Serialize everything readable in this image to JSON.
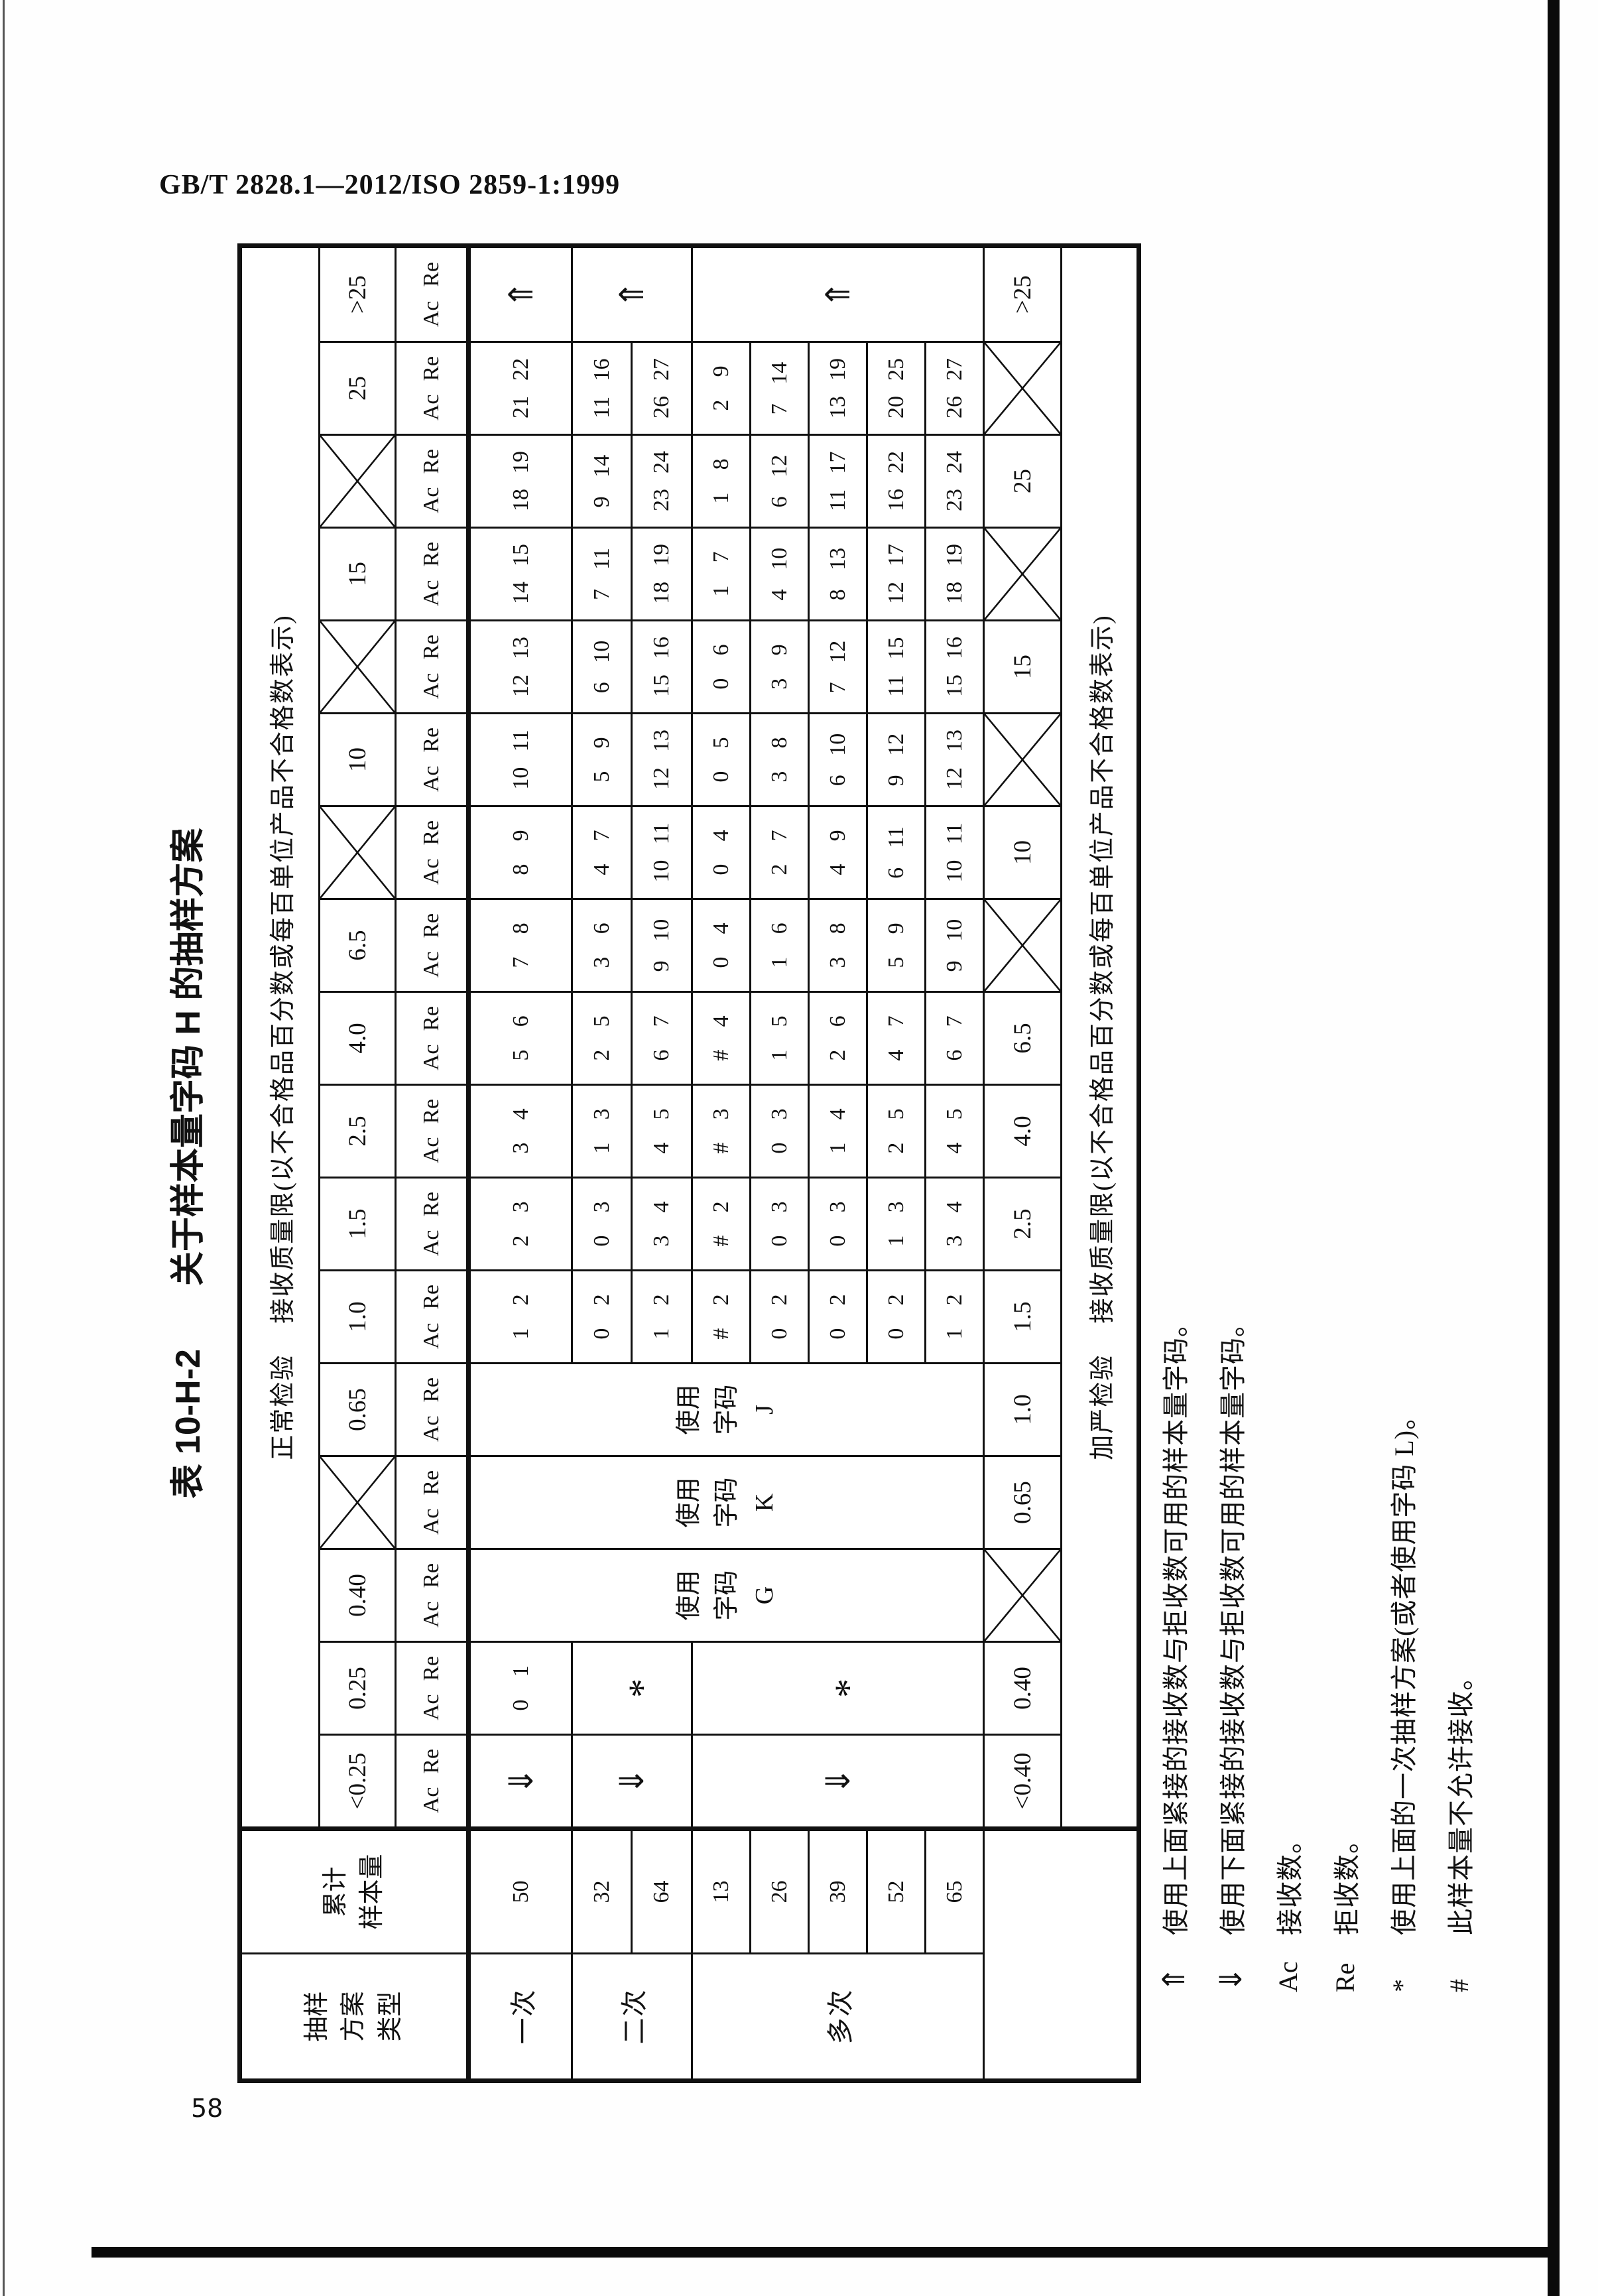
{
  "page": {
    "standard_ref": "GB/T 2828.1—2012/ISO 2859-1:1999",
    "page_number": "58"
  },
  "table": {
    "title_no": "表 10-H-2",
    "title_text": "关于样本量字码 H 的抽样方案",
    "normal_header_prefix": "正常检验",
    "normal_header_rest": "接收质量限(以不合格品百分数或每百单位产品不合格数表示)",
    "tightened_header_prefix": "加严检验",
    "tightened_header_rest": "接收质量限(以不合格品百分数或每百单位产品不合格数表示)",
    "type_header_lines": [
      "抽样",
      "方案",
      "类型"
    ],
    "size_header_lines": [
      "累计",
      "样本量"
    ],
    "ac_label": "Ac",
    "re_label": "Re",
    "row_groups": [
      {
        "label": "一次",
        "sizes": [
          "50"
        ]
      },
      {
        "label": "二次",
        "sizes": [
          "32",
          "64"
        ]
      },
      {
        "label": "多次",
        "sizes": [
          "13",
          "26",
          "39",
          "52",
          "65"
        ]
      }
    ],
    "columns": [
      {
        "aql": "<0.25",
        "aql_cross": false,
        "kind": "arrows",
        "glyph": "⇓",
        "tight": "<0.40",
        "tight_cross": false
      },
      {
        "aql": "0.25",
        "aql_cross": false,
        "kind": "star",
        "single": [
          "0",
          "1"
        ],
        "star": "*",
        "tight": "0.40",
        "tight_cross": false
      },
      {
        "aql": "0.40",
        "aql_cross": false,
        "kind": "code",
        "code_lines": [
          "使用",
          "字码",
          "G"
        ],
        "tight": "",
        "tight_cross": true
      },
      {
        "aql": "",
        "aql_cross": true,
        "kind": "code",
        "code_lines": [
          "使用",
          "字码",
          "K"
        ],
        "tight": "0.65",
        "tight_cross": false
      },
      {
        "aql": "0.65",
        "aql_cross": false,
        "kind": "code",
        "code_lines": [
          "使用",
          "字码",
          "J"
        ],
        "tight": "1.0",
        "tight_cross": false
      },
      {
        "aql": "1.0",
        "aql_cross": false,
        "kind": "data",
        "single": [
          "1",
          "2"
        ],
        "double": [
          [
            "0",
            "2"
          ],
          [
            "1",
            "2"
          ]
        ],
        "multiple": [
          [
            "#",
            "2"
          ],
          [
            "0",
            "2"
          ],
          [
            "0",
            "2"
          ],
          [
            "0",
            "2"
          ],
          [
            "1",
            "2"
          ]
        ],
        "tight": "1.5",
        "tight_cross": false
      },
      {
        "aql": "1.5",
        "aql_cross": false,
        "kind": "data",
        "single": [
          "2",
          "3"
        ],
        "double": [
          [
            "0",
            "3"
          ],
          [
            "3",
            "4"
          ]
        ],
        "multiple": [
          [
            "#",
            "2"
          ],
          [
            "0",
            "3"
          ],
          [
            "0",
            "3"
          ],
          [
            "1",
            "3"
          ],
          [
            "3",
            "4"
          ]
        ],
        "tight": "2.5",
        "tight_cross": false
      },
      {
        "aql": "2.5",
        "aql_cross": false,
        "kind": "data",
        "single": [
          "3",
          "4"
        ],
        "double": [
          [
            "1",
            "3"
          ],
          [
            "4",
            "5"
          ]
        ],
        "multiple": [
          [
            "#",
            "3"
          ],
          [
            "0",
            "3"
          ],
          [
            "1",
            "4"
          ],
          [
            "2",
            "5"
          ],
          [
            "4",
            "5"
          ]
        ],
        "tight": "4.0",
        "tight_cross": false
      },
      {
        "aql": "4.0",
        "aql_cross": false,
        "kind": "data",
        "single": [
          "5",
          "6"
        ],
        "double": [
          [
            "2",
            "5"
          ],
          [
            "6",
            "7"
          ]
        ],
        "multiple": [
          [
            "#",
            "4"
          ],
          [
            "1",
            "5"
          ],
          [
            "2",
            "6"
          ],
          [
            "4",
            "7"
          ],
          [
            "6",
            "7"
          ]
        ],
        "tight": "6.5",
        "tight_cross": false
      },
      {
        "aql": "6.5",
        "aql_cross": false,
        "kind": "data",
        "single": [
          "7",
          "8"
        ],
        "double": [
          [
            "3",
            "6"
          ],
          [
            "9",
            "10"
          ]
        ],
        "multiple": [
          [
            "0",
            "4"
          ],
          [
            "1",
            "6"
          ],
          [
            "3",
            "8"
          ],
          [
            "5",
            "9"
          ],
          [
            "9",
            "10"
          ]
        ],
        "tight": "",
        "tight_cross": true
      },
      {
        "aql": "",
        "aql_cross": true,
        "kind": "data",
        "single": [
          "8",
          "9"
        ],
        "double": [
          [
            "4",
            "7"
          ],
          [
            "10",
            "11"
          ]
        ],
        "multiple": [
          [
            "0",
            "4"
          ],
          [
            "2",
            "7"
          ],
          [
            "4",
            "9"
          ],
          [
            "6",
            "11"
          ],
          [
            "10",
            "11"
          ]
        ],
        "tight": "10",
        "tight_cross": false
      },
      {
        "aql": "10",
        "aql_cross": false,
        "kind": "data",
        "single": [
          "10",
          "11"
        ],
        "double": [
          [
            "5",
            "9"
          ],
          [
            "12",
            "13"
          ]
        ],
        "multiple": [
          [
            "0",
            "5"
          ],
          [
            "3",
            "8"
          ],
          [
            "6",
            "10"
          ],
          [
            "9",
            "12"
          ],
          [
            "12",
            "13"
          ]
        ],
        "tight": "",
        "tight_cross": true
      },
      {
        "aql": "",
        "aql_cross": true,
        "kind": "data",
        "single": [
          "12",
          "13"
        ],
        "double": [
          [
            "6",
            "10"
          ],
          [
            "15",
            "16"
          ]
        ],
        "multiple": [
          [
            "0",
            "6"
          ],
          [
            "3",
            "9"
          ],
          [
            "7",
            "12"
          ],
          [
            "11",
            "15"
          ],
          [
            "15",
            "16"
          ]
        ],
        "tight": "15",
        "tight_cross": false
      },
      {
        "aql": "15",
        "aql_cross": false,
        "kind": "data",
        "single": [
          "14",
          "15"
        ],
        "double": [
          [
            "7",
            "11"
          ],
          [
            "18",
            "19"
          ]
        ],
        "multiple": [
          [
            "1",
            "7"
          ],
          [
            "4",
            "10"
          ],
          [
            "8",
            "13"
          ],
          [
            "12",
            "17"
          ],
          [
            "18",
            "19"
          ]
        ],
        "tight": "",
        "tight_cross": true
      },
      {
        "aql": "",
        "aql_cross": true,
        "kind": "data",
        "single": [
          "18",
          "19"
        ],
        "double": [
          [
            "9",
            "14"
          ],
          [
            "23",
            "24"
          ]
        ],
        "multiple": [
          [
            "1",
            "8"
          ],
          [
            "6",
            "12"
          ],
          [
            "11",
            "17"
          ],
          [
            "16",
            "22"
          ],
          [
            "23",
            "24"
          ]
        ],
        "tight": "25",
        "tight_cross": false
      },
      {
        "aql": "25",
        "aql_cross": false,
        "kind": "data",
        "single": [
          "21",
          "22"
        ],
        "double": [
          [
            "11",
            "16"
          ],
          [
            "26",
            "27"
          ]
        ],
        "multiple": [
          [
            "2",
            "9"
          ],
          [
            "7",
            "14"
          ],
          [
            "13",
            "19"
          ],
          [
            "20",
            "25"
          ],
          [
            "26",
            "27"
          ]
        ],
        "tight": "",
        "tight_cross": true
      },
      {
        "aql": ">25",
        "aql_cross": false,
        "kind": "arrows",
        "glyph": "⇑",
        "tight": ">25",
        "tight_cross": false
      }
    ]
  },
  "footnotes": [
    {
      "symbol": "⇑",
      "text": "使用上面紧接的接收数与拒收数可用的样本量字码。"
    },
    {
      "symbol": "⇓",
      "text": "使用下面紧接的接收数与拒收数可用的样本量字码。"
    },
    {
      "symbol": "Ac",
      "text": "接收数。"
    },
    {
      "symbol": "Re",
      "text": "拒收数。"
    },
    {
      "symbol": "*",
      "text": "使用上面的一次抽样方案(或者使用字码 L)。"
    },
    {
      "symbol": "#",
      "text": "此样本量不允许接收。"
    }
  ]
}
